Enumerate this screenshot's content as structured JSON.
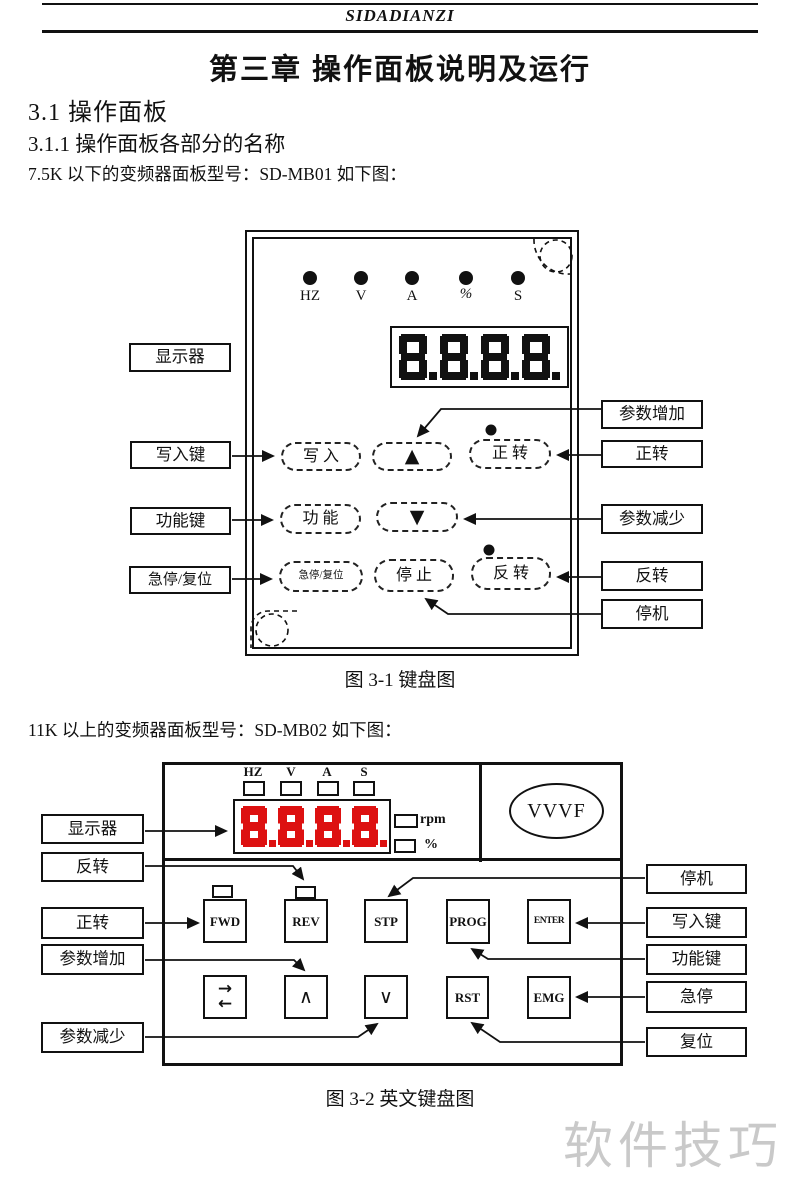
{
  "page": {
    "brand": "SIDADIANZI",
    "chapter_title": "第三章 操作面板说明及运行",
    "section_31": "3.1  操作面板",
    "section_311": "3.1.1 操作面板各部分的名称",
    "para_75k": "7.5K 以下的变频器面板型号：SD-MB01 如下图：",
    "para_11k": "11K 以上的变频器面板型号：SD-MB02 如下图：",
    "watermark": "软件技巧"
  },
  "fig1": {
    "caption": "图 3-1 键盘图",
    "indicators": [
      "HZ",
      "V",
      "A",
      "%",
      "S"
    ],
    "display_value": "8.8.8.8.",
    "left_labels": [
      "显示器",
      "写入键",
      "功能键",
      "急停/复位"
    ],
    "right_labels": [
      "参数增加",
      "正转",
      "参数减少",
      "反转",
      "停机"
    ],
    "buttons": {
      "write": "写 入",
      "up": "▲",
      "forward": "正 转",
      "function": "功 能",
      "down": "▼",
      "estop_reset": "急停/复位",
      "stop": "停 止",
      "reverse": "反 转"
    }
  },
  "fig2": {
    "caption": "图 3-2 英文键盘图",
    "indicators": [
      "HZ",
      "V",
      "A",
      "S"
    ],
    "display_value": "8.8.8.8.",
    "unit_labels": [
      "rpm",
      "%"
    ],
    "logo": "VVVF",
    "left_labels": [
      "显示器",
      "反转",
      "正转",
      "参数增加",
      "参数减少"
    ],
    "right_labels": [
      "停机",
      "写入键",
      "功能键",
      "急停",
      "复位"
    ],
    "buttons": {
      "fwd": "FWD",
      "rev": "REV",
      "stp": "STP",
      "prog": "PROG",
      "enter": "ENTER",
      "shift_top": "→",
      "shift_bottom": "←",
      "up": "∧",
      "down": "∨",
      "rst": "RST",
      "emg": "EMG"
    }
  },
  "colors": {
    "ink": "#111111",
    "display_red": "#dd1111",
    "watermark_gray": "#c9c9c9"
  }
}
